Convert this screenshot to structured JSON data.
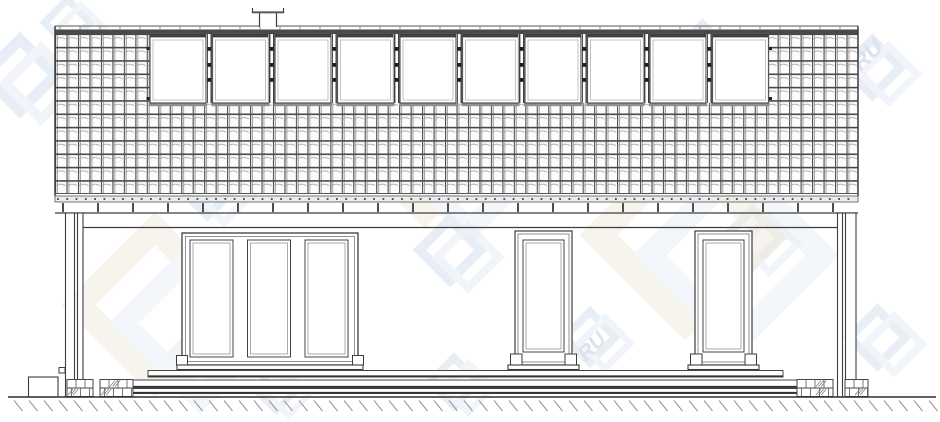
{
  "meta": {
    "description": "Architectural side elevation drawing of a single-storey house with attic roof windows, terrace steps and ground hatching",
    "canvas": {
      "w": 940,
      "h": 422
    },
    "ink": "#3d3d3d",
    "ink_mid": "#6a6a6a",
    "ink_light": "#9a9a9a"
  },
  "watermark": {
    "text_fragment": "RU",
    "logo_color": "#d9e3ef",
    "logo_color2": "#e9eff7",
    "big_color": "#f0ebdf",
    "text_color": "#c5d2e2",
    "logos": [
      {
        "x": -15,
        "y": 40,
        "s": 70
      },
      {
        "x": 45,
        "y": 0,
        "s": 45
      },
      {
        "x": 180,
        "y": 160,
        "s": 55
      },
      {
        "x": 195,
        "y": 290,
        "s": 55,
        "text": "RU",
        "tx": 213,
        "ty": 344
      },
      {
        "x": 255,
        "y": 368,
        "s": 42
      },
      {
        "x": 420,
        "y": 220,
        "s": 60
      },
      {
        "x": 430,
        "y": 358,
        "s": 48
      },
      {
        "x": 505,
        "y": 65,
        "s": 55
      },
      {
        "x": 565,
        "y": 312,
        "s": 50,
        "text": "RU",
        "tx": 586,
        "ty": 362
      },
      {
        "x": 675,
        "y": 25,
        "s": 55
      },
      {
        "x": 725,
        "y": 210,
        "s": 55
      },
      {
        "x": 845,
        "y": 40,
        "s": 55,
        "text": "RU",
        "tx": 861,
        "ty": 72
      },
      {
        "x": 850,
        "y": 310,
        "s": 55
      },
      {
        "x": 350,
        "y": 60,
        "s": 150,
        "big": true
      },
      {
        "x": 80,
        "y": 230,
        "s": 150,
        "big": true
      },
      {
        "x": 600,
        "y": 150,
        "s": 170,
        "big": true
      }
    ]
  },
  "drawing": {
    "roof": {
      "x1": 55,
      "x2": 858,
      "ridge_line_y": 26,
      "ridge_band_y": 29.5,
      "ridge_band_h": 4,
      "ridge_tick_step": 20,
      "tile_top": 33.5,
      "tile_bottom": 193.5
    },
    "chimney": {
      "cap_x1": 252.5,
      "cap_x2": 283.5,
      "cap_top": 8,
      "cap_y": 12.5,
      "flue_x1": 259.5,
      "flue_x2": 276.5,
      "flue_bottom": 27,
      "base": {
        "x": 262,
        "y": 33.5,
        "w": 13,
        "h": 7.5
      }
    },
    "roof_windows": {
      "count": 10,
      "x_start": 150,
      "pitch": 62.5,
      "w": 56,
      "y": 34,
      "h": 69,
      "top_bar_h": 3.4,
      "hinge_ys": [
        47,
        63,
        78
      ],
      "edge_mark_ys": [
        47,
        97
      ]
    },
    "eaves": {
      "tile_bottom_line_y": 193.5,
      "gutter": {
        "y": 196,
        "h": 6
      },
      "rafter_ticks": {
        "y": 203,
        "h": 9,
        "x_start": 62,
        "x_end": 853,
        "step": 35
      },
      "soffit_y": 213
    },
    "wall": {
      "top_y": 227.5,
      "x1": 83,
      "x2": 837
    },
    "posts": [
      {
        "x": 65.5,
        "w": 9,
        "y1": 213,
        "y2": 397
      },
      {
        "x": 77.5,
        "w": 5.5,
        "y1": 213,
        "y2": 397
      },
      {
        "x": 837.5,
        "w": 5,
        "y1": 213,
        "y2": 397
      },
      {
        "x": 845.5,
        "w": 10.5,
        "y1": 213,
        "y2": 397
      }
    ],
    "triple_door": {
      "x": 182,
      "y": 233,
      "w": 176,
      "h": 132,
      "glass": [
        {
          "x": 190,
          "w": 43
        },
        {
          "x": 247.5,
          "w": 43
        },
        {
          "x": 305,
          "w": 43
        }
      ],
      "glass_y": 240,
      "glass_h": 117,
      "feet_x": [
        176.5,
        352.5
      ],
      "foot": {
        "y": 355.5,
        "w": 11,
        "h": 9.5
      },
      "sill": {
        "x": 177,
        "w": 186,
        "y": 365,
        "h": 4.5
      }
    },
    "single_doors": [
      {
        "x": 515,
        "y": 231,
        "w": 57,
        "h": 134,
        "feet_x": [
          510.5,
          565
        ],
        "foot": {
          "y": 354,
          "w": 11.5,
          "h": 11
        },
        "sill": {
          "x": 508,
          "w": 71,
          "y": 365,
          "h": 4.5
        }
      },
      {
        "x": 695,
        "y": 231,
        "w": 57,
        "h": 134,
        "feet_x": [
          690.5,
          745
        ],
        "foot": {
          "y": 354,
          "w": 11.5,
          "h": 11
        },
        "sill": {
          "x": 688,
          "w": 71,
          "y": 365,
          "h": 4.5
        }
      }
    ],
    "deck_bands": [
      {
        "x1": 148,
        "x2": 783,
        "y1": 370.5,
        "y2": 377
      },
      {
        "x1": 128,
        "x2": 797,
        "y1": 380,
        "y2": 387.5
      },
      {
        "x1": 107,
        "x2": 810,
        "y1": 388.5,
        "y2": 393.5
      }
    ],
    "masonry": [
      {
        "x": 67,
        "w": 26,
        "hatch": [
          3
        ]
      },
      {
        "x": 100,
        "w": 33,
        "hatch": [
          1,
          6
        ]
      },
      {
        "x": 797,
        "w": 36,
        "hatch": [
          2,
          5
        ]
      },
      {
        "x": 845,
        "w": 23,
        "hatch": [
          4
        ]
      }
    ],
    "masonry_rows": {
      "y": 379.5,
      "h": 17,
      "mid": 388,
      "joint_step": 9
    },
    "box": {
      "x": 28.5,
      "y": 377,
      "w": 29.5,
      "h": 20
    },
    "bracket": {
      "x": 59,
      "y": 367.5,
      "w": 6,
      "h": 5.5
    },
    "ground": {
      "y": 397,
      "x1": 8,
      "x2": 936,
      "hatch_step": 15,
      "hatch_dx": 8.5,
      "hatch_dy": 10.5
    }
  }
}
